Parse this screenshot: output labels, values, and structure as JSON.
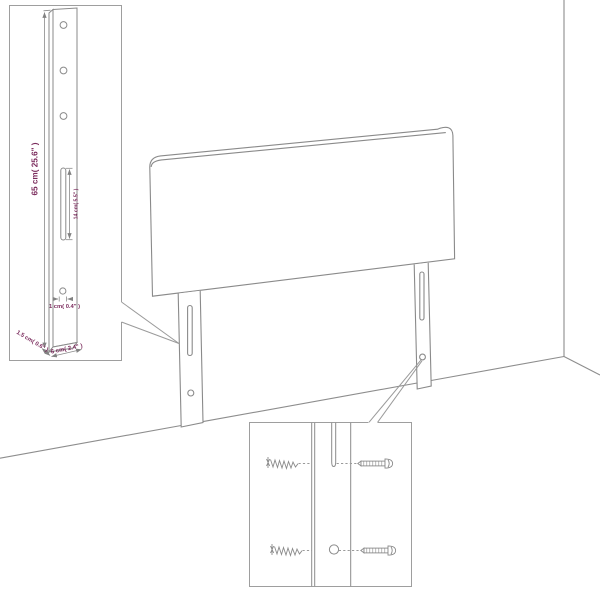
{
  "colors": {
    "background": "#ffffff",
    "line": "#8a8a8a",
    "box_border": "#9e9e9e",
    "dimension_text": "#7b2c5d"
  },
  "leg_detail": {
    "height_label": "65 cm( 25.6\" )",
    "slot_label": "14 cm( 5.5\" )",
    "hole_label": "1 cm( 0.4\" )",
    "depth_label": "1.5 cm( 0.6\" )",
    "width_label": "6 cm( 2.4\" )"
  }
}
